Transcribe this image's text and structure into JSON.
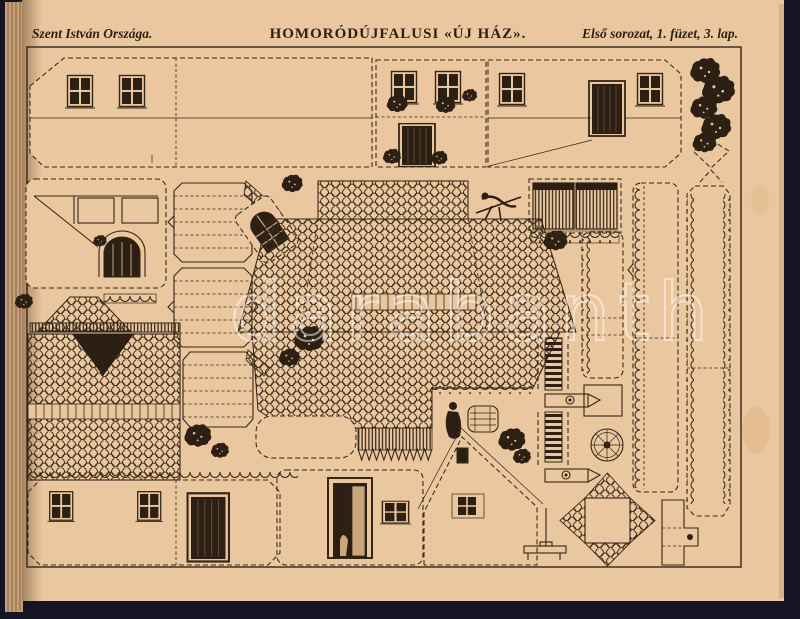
{
  "page": {
    "header": {
      "series_left": "Szent István Országa.",
      "title_center": "HOMORÓDÚJFALUSI «ÚJ HÁZ».",
      "issue_right": "Első sorozat, 1. füzet, 3. lap."
    },
    "watermark": "darabanth",
    "colors": {
      "paper": "#ebc79f",
      "ink": "#342718",
      "dark_fill": "#2b2013",
      "background": "#141425",
      "watermark_white": "#ffffff"
    }
  }
}
